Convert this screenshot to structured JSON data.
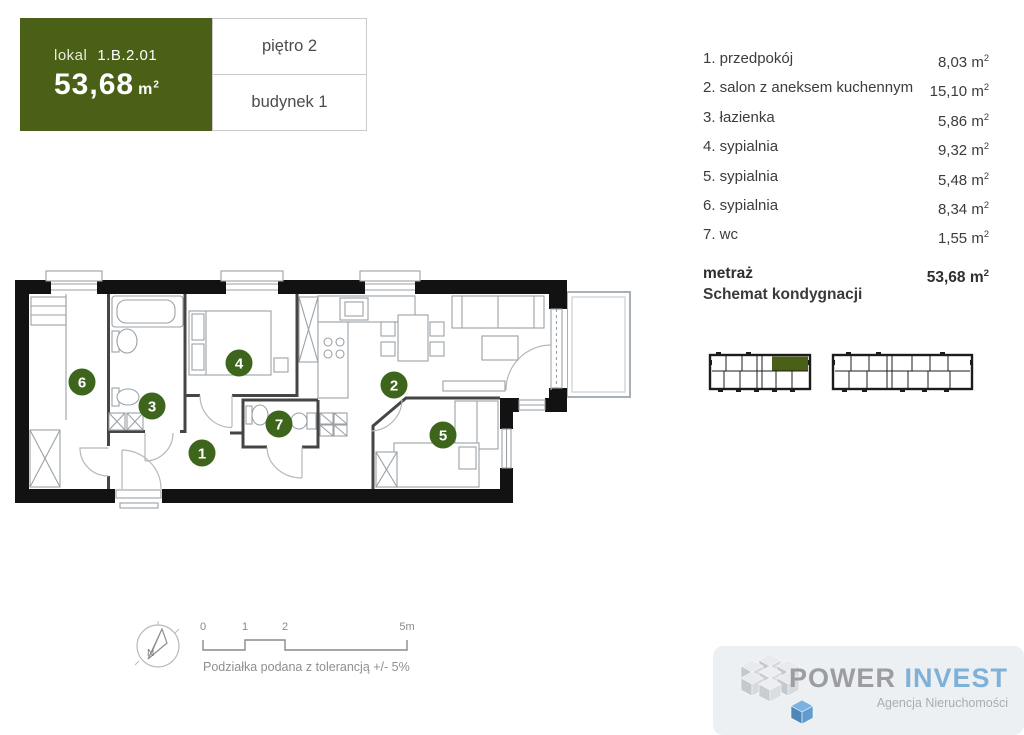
{
  "header": {
    "lokal_label": "lokal",
    "lokal_value": "1.B.2.01",
    "area_value": "53,68",
    "floor": "piętro 2",
    "building": "budynek 1"
  },
  "units": {
    "base": "m",
    "exp": "2"
  },
  "rooms": {
    "items": [
      {
        "label": "1. przedpokój",
        "area": "8,03"
      },
      {
        "label": "2. salon z aneksem kuchennym",
        "area": "15,10"
      },
      {
        "label": "3. łazienka",
        "area": "5,86"
      },
      {
        "label": "4. sypialnia",
        "area": "9,32"
      },
      {
        "label": "5. sypialnia",
        "area": "5,48"
      },
      {
        "label": "6. sypialnia",
        "area": "8,34"
      },
      {
        "label": "7. wc",
        "area": "1,55"
      }
    ],
    "total_label": "metraż",
    "total_area": "53,68"
  },
  "schemat": {
    "title": "Schemat kondygnacji"
  },
  "plan": {
    "badges": [
      {
        "num": "1"
      },
      {
        "num": "2"
      },
      {
        "num": "3"
      },
      {
        "num": "4"
      },
      {
        "num": "5"
      },
      {
        "num": "6"
      },
      {
        "num": "7"
      }
    ]
  },
  "scale": {
    "t0": "0",
    "t1": "1",
    "t2": "2",
    "t5": "5m",
    "north": "N",
    "tolerance": "Podziałka podana z tolerancją +/- 5%"
  },
  "logo": {
    "power": "POWER",
    "invest": "INVEST",
    "subtitle": "Agencja Nieruchomości"
  },
  "colors": {
    "accent_green": "#4a6016",
    "badge_green": "#3e651c",
    "logo_blue": "#7eb1d8",
    "logo_gray": "#9b9da0"
  }
}
